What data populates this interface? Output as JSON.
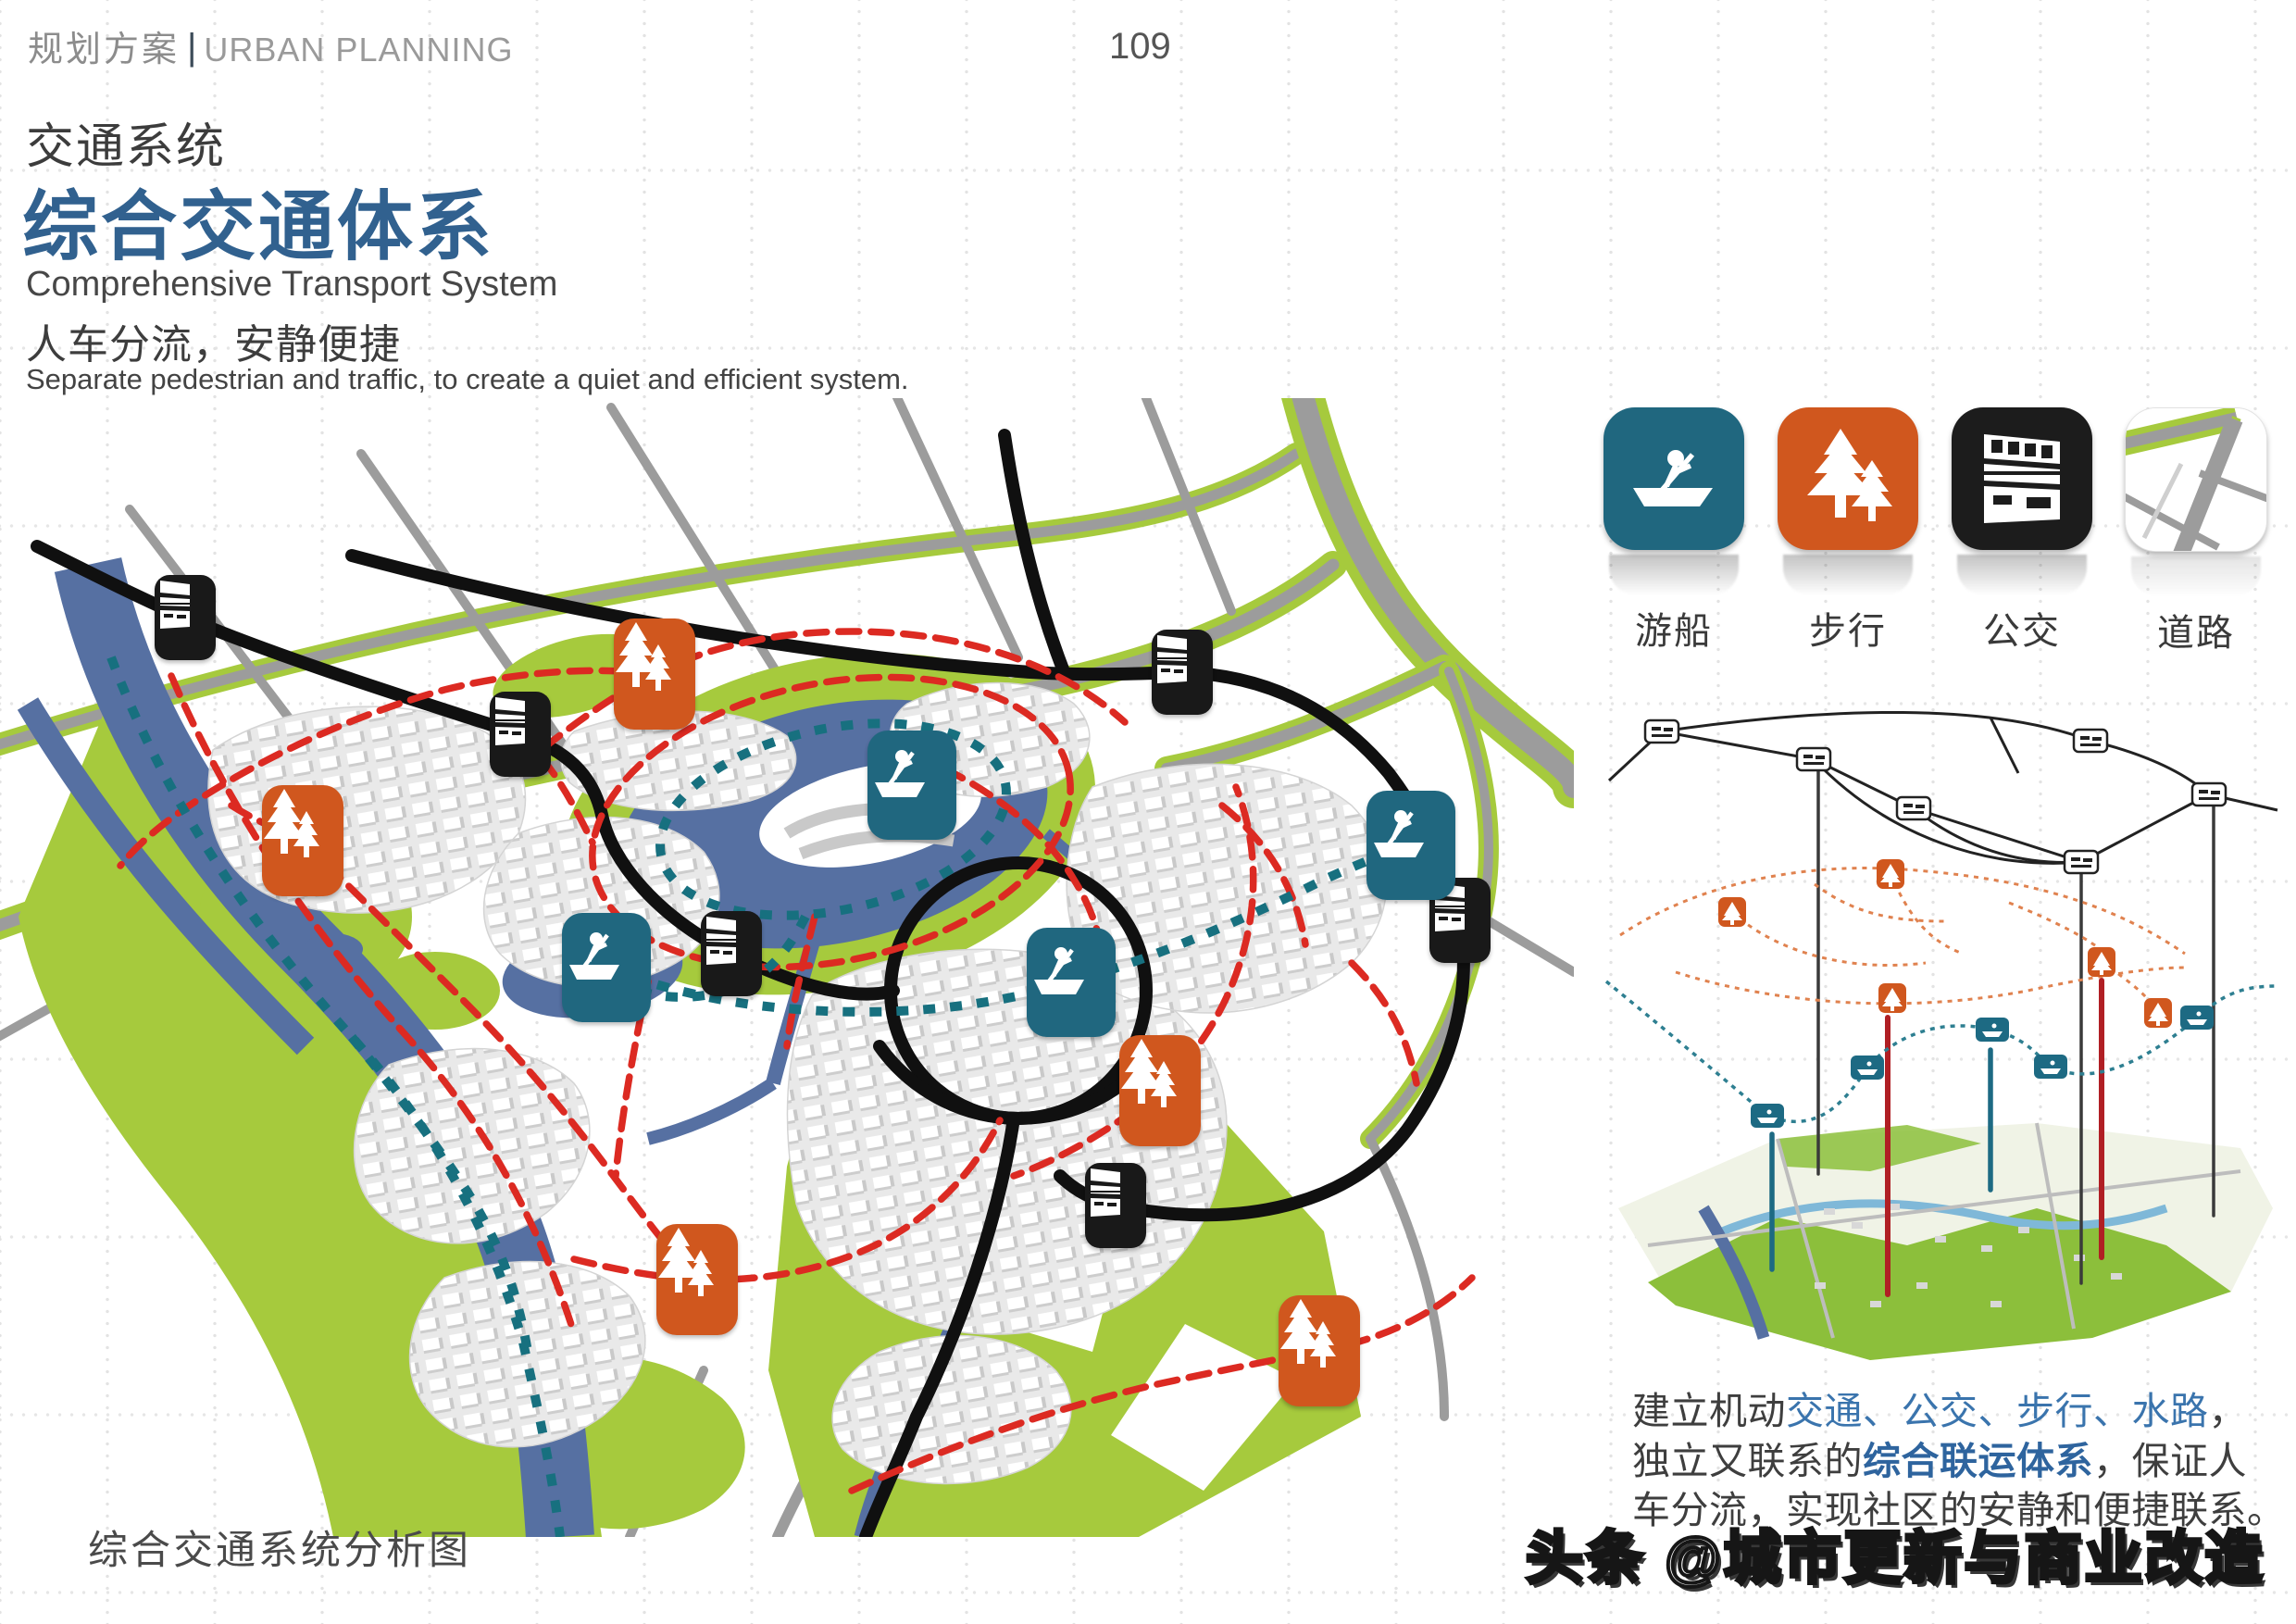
{
  "header": {
    "title_zh": "规划方案",
    "divider": "|",
    "title_en": "URBAN PLANNING"
  },
  "page": {
    "number": "109"
  },
  "titles": {
    "section_zh": "交通系统",
    "main_zh": "综合交通体系",
    "main_en": "Comprehensive Transport System",
    "sub_zh": "人车分流，安静便捷",
    "sub_en": "Separate pedestrian and traffic, to create a quiet and efficient system."
  },
  "legend": {
    "items": [
      {
        "label": "游船",
        "icon": "boat-icon",
        "color": "#20677f"
      },
      {
        "label": "步行",
        "icon": "pine-trees-icon",
        "color": "#d0571e"
      },
      {
        "label": "公交",
        "icon": "bus-icon",
        "color": "#1c1c1c"
      },
      {
        "label": "道路",
        "icon": "road-map-icon",
        "color": "#ffffff"
      }
    ]
  },
  "paragraph": {
    "seg1": "建立机动",
    "seg2": "交通、公交、步行、水路",
    "seg3": "，",
    "seg4": "独立又联系的",
    "seg5": "综合联运体系",
    "seg6": "，保证人",
    "seg7": "车分流，实现社区的安静和便捷联系。"
  },
  "caption": "综合交通系统分析图",
  "watermark": "头条 @城市更新与商业改造",
  "colors": {
    "accent_blue": "#31618f",
    "map_water": "#5670a2",
    "map_green": "#a6ca3d",
    "route_red": "#dc2a22",
    "route_teal": "#17707f",
    "icon_orange": "#d0571e",
    "icon_teal": "#20677f",
    "road_gray": "#9c9c9c"
  }
}
